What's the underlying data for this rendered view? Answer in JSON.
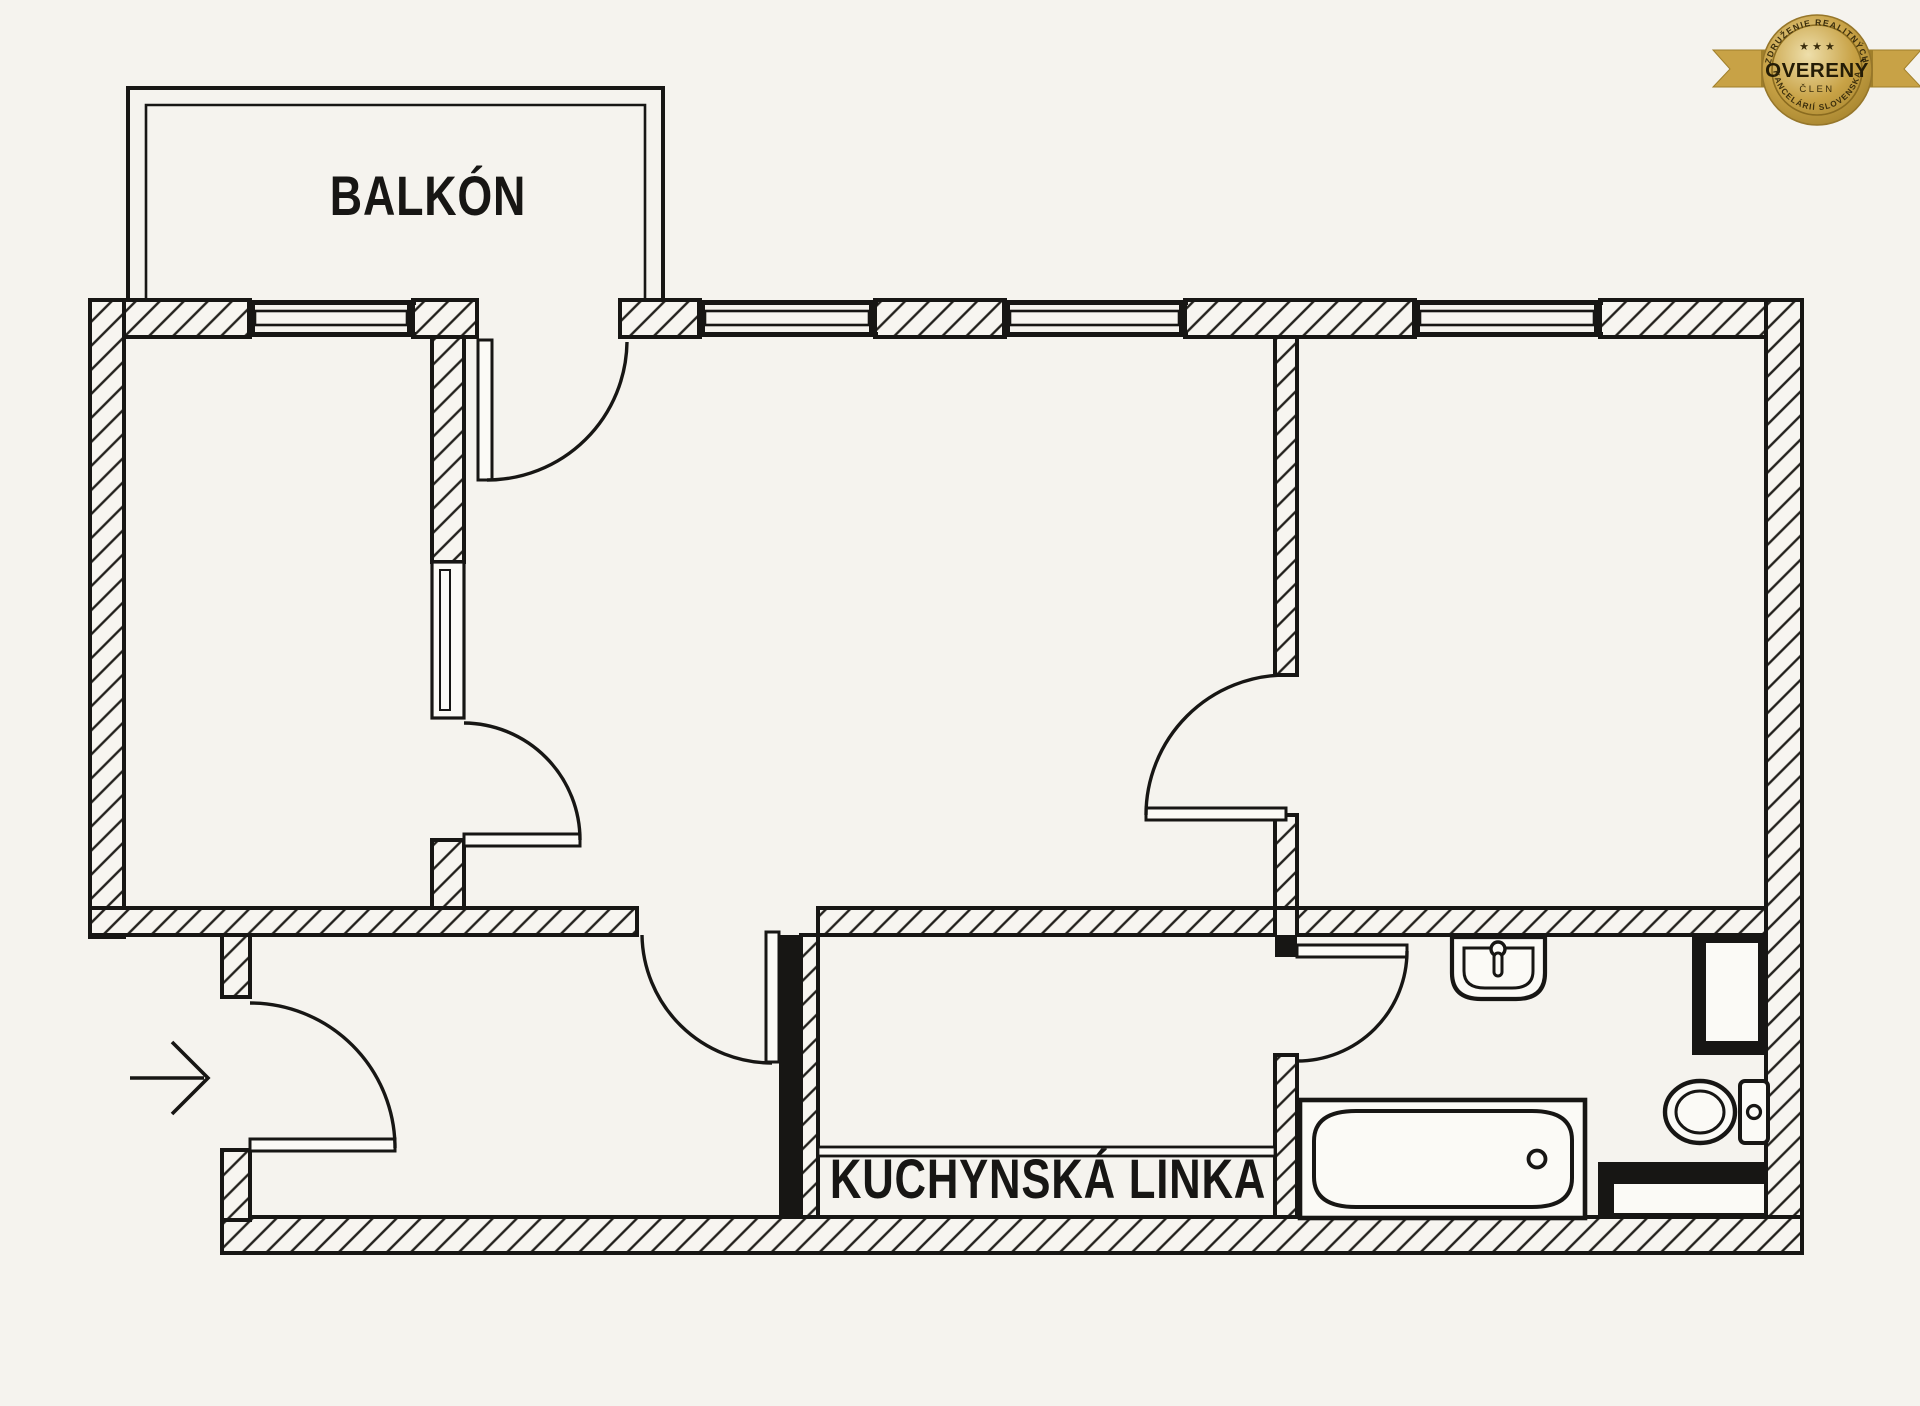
{
  "page": {
    "bg": "#f5f3ee",
    "ink": "#171614"
  },
  "plan": {
    "balcony_label": "BALKÓN",
    "kitchen_label": "KUCHYNSKÁ LINKA"
  },
  "badge": {
    "arc_top": "ZDRUŽENIE REALITNÝCH",
    "stars": "★ ★ ★",
    "title": "OVERENÝ",
    "member": "ČLEN",
    "arc_bottom": "KANCELÁRIÍ SLOVENSKA",
    "gold": "#c8a246",
    "gold_dark": "#a07f2a",
    "gold_deep": "#8a6b1f",
    "gold_light": "#eedfab",
    "text_ink": "#3a2d0c"
  }
}
